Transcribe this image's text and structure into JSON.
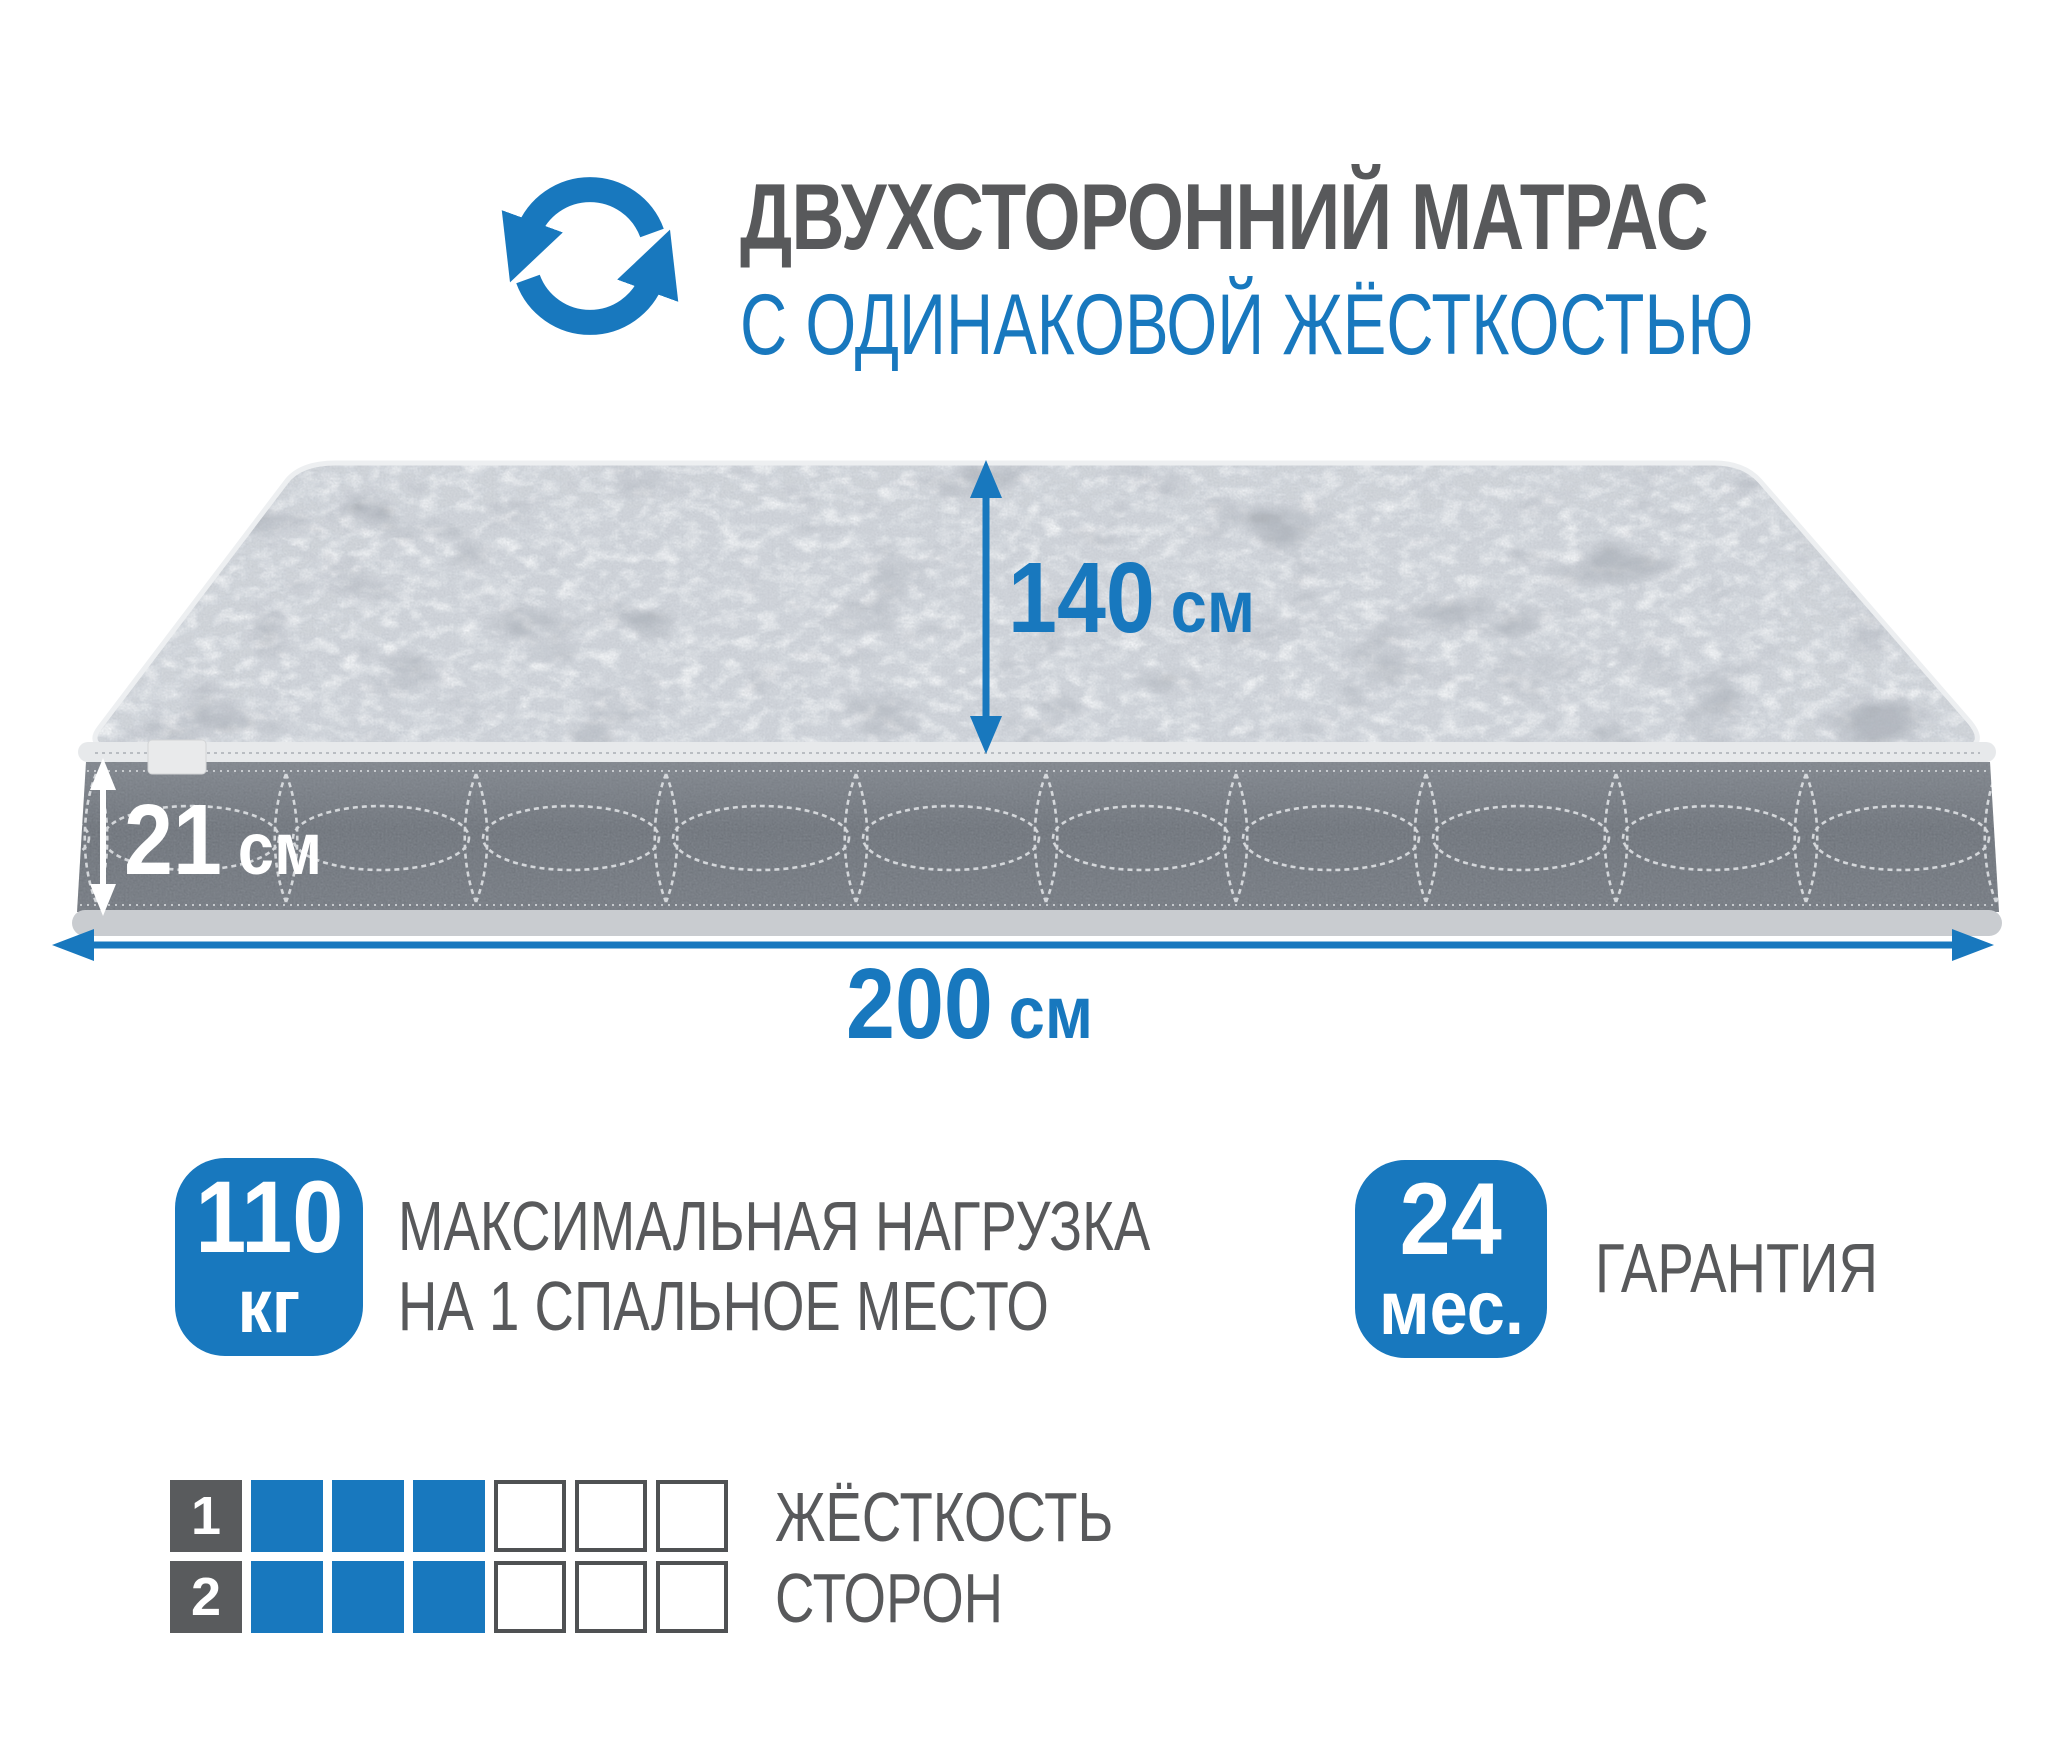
{
  "colors": {
    "accent_blue": "#1878be",
    "text_gray": "#58595b",
    "cell_label_gray": "#595b5d",
    "cell_border_gray": "#4f5153",
    "mattress_top_gray": "#b3b7bd",
    "mattress_side_gray": "#6e737a",
    "piping_light": "#e7e9eb"
  },
  "header": {
    "icon": "rotate-arrows-icon",
    "title_line1": "ДВУХСТОРОННИЙ МАТРАС",
    "title_line2": "С ОДИНАКОВОЙ ЖЁСТКОСТЬЮ"
  },
  "dimensions": {
    "width": {
      "value": "140",
      "unit": "см"
    },
    "thickness": {
      "value": "21",
      "unit": "см"
    },
    "length": {
      "value": "200",
      "unit": "см"
    }
  },
  "badges": {
    "max_load": {
      "value": "110",
      "unit": "кг",
      "caption_line1": "МАКСИМАЛЬНАЯ НАГРУЗКА",
      "caption_line2": "НА 1 СПАЛЬНОЕ МЕСТО"
    },
    "warranty": {
      "value": "24",
      "unit": "мес.",
      "caption": "ГАРАНТИЯ"
    }
  },
  "firmness": {
    "caption_line1": "ЖЁСТКОСТЬ",
    "caption_line2": "СТОРОН",
    "scale_max": 6,
    "rows": [
      {
        "label": "1",
        "filled": 3
      },
      {
        "label": "2",
        "filled": 3
      }
    ]
  }
}
